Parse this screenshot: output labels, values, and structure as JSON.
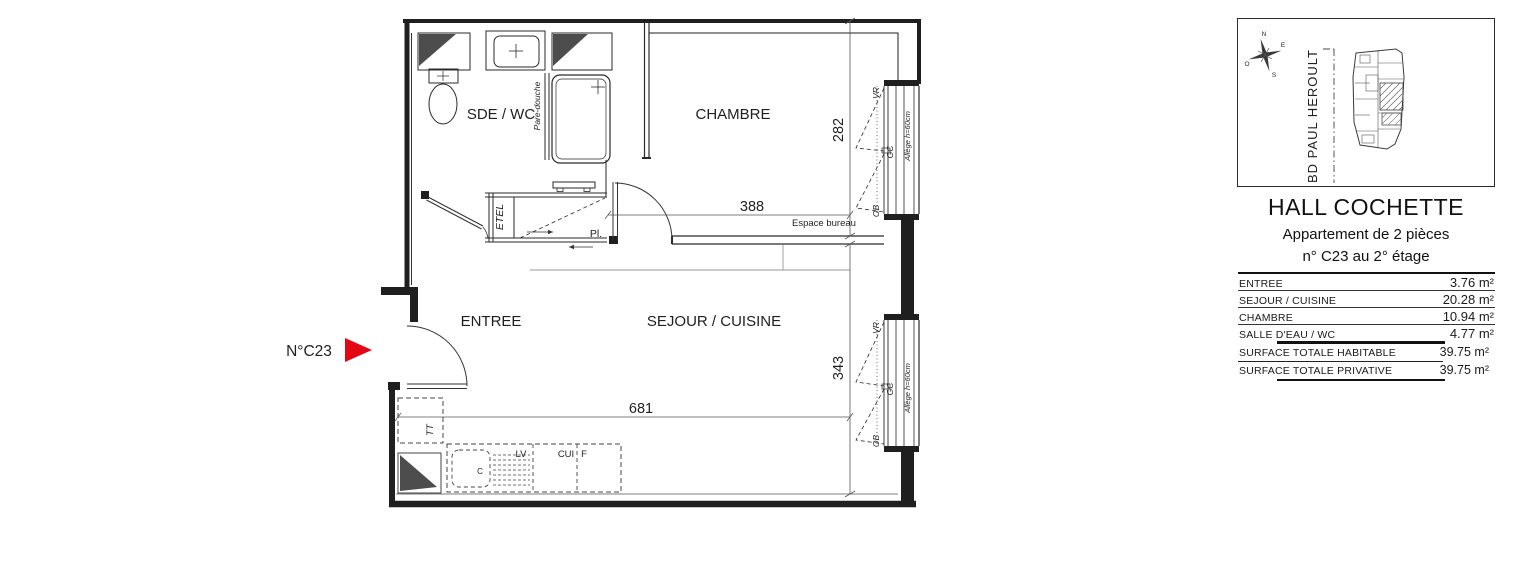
{
  "colors": {
    "accent_red": "#e30613",
    "wall": "#1f1f1f",
    "dark_fill": "#4d4d4d"
  },
  "plan": {
    "unit_pointer": "N°C23",
    "rooms": {
      "sde_wc": "SDE / WC",
      "chambre": "CHAMBRE",
      "entree": "ENTREE",
      "sejour_cuisine": "SEJOUR / CUISINE"
    },
    "dims": {
      "chambre_h": "282",
      "sejour_h": "343",
      "chambre_w": "388",
      "sejour_w": "681"
    },
    "labels": {
      "pare_douche": "Pare-douche",
      "etel": "ETEL",
      "placard": "Pl.",
      "espace_bureau": "Espace bureau",
      "tt": "TT",
      "lave_vaisselle": "LV",
      "cuisine": "CUI",
      "frigo": "F",
      "sink_c": "C"
    },
    "window": {
      "vr": "VR",
      "gc": "GC",
      "ob": "OB",
      "allege": "Allège h=60cm"
    }
  },
  "panel": {
    "compass": {
      "n": "N",
      "e": "E",
      "s": "S",
      "o": "O"
    },
    "street": "BD PAUL HEROULT",
    "title": "HALL COCHETTE",
    "subtitle": "Appartement de 2 pièces",
    "unit_line": "n° C23 au 2° étage",
    "areas": {
      "rows": [
        {
          "label": "ENTREE",
          "value": "3.76 m²"
        },
        {
          "label": "SEJOUR / CUISINE",
          "value": "20.28 m²"
        },
        {
          "label": "CHAMBRE",
          "value": "10.94 m²"
        },
        {
          "label": "SALLE D'EAU / WC",
          "value": "4.77 m²"
        }
      ],
      "totals": [
        {
          "label": "SURFACE TOTALE HABITABLE",
          "value": "39.75 m²"
        },
        {
          "label": "SURFACE TOTALE PRIVATIVE",
          "value": "39.75 m²"
        }
      ]
    }
  }
}
